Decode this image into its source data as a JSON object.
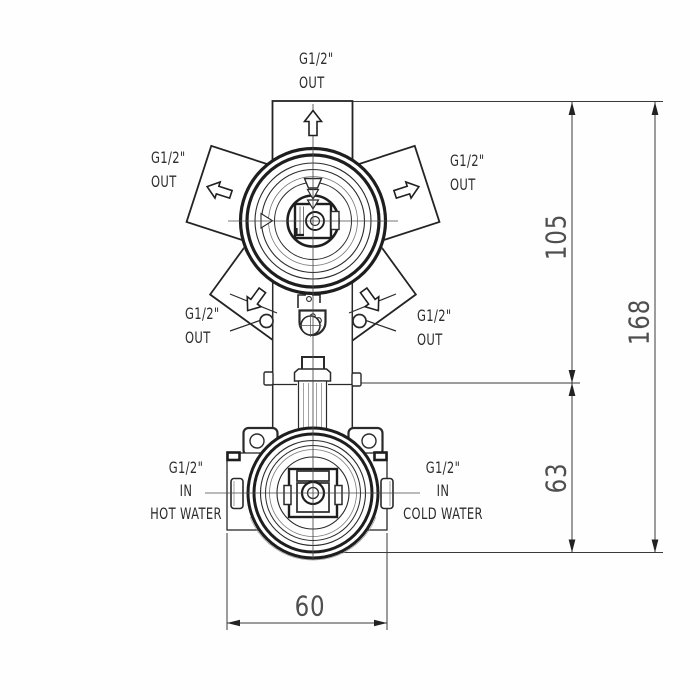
{
  "labels": {
    "outlet_top": {
      "size": "G1/2\"",
      "flow": "OUT"
    },
    "outlet_upper_left": {
      "size": "G1/2\"",
      "flow": "OUT"
    },
    "outlet_upper_right": {
      "size": "G1/2\"",
      "flow": "OUT"
    },
    "outlet_lower_left": {
      "size": "G1/2\"",
      "flow": "OUT"
    },
    "outlet_lower_right": {
      "size": "G1/2\"",
      "flow": "OUT"
    },
    "inlet_hot": {
      "size": "G1/2\"",
      "flow": "IN",
      "medium": "HOT WATER"
    },
    "inlet_cold": {
      "size": "G1/2\"",
      "flow": "IN",
      "medium": "COLD WATER"
    }
  },
  "dimensions": {
    "upper_section": "105",
    "lower_section": "63",
    "overall_height": "168",
    "body_width": "60"
  },
  "colors": {
    "line": "#2a2a2a",
    "dim_line": "#3a3a3a",
    "text": "#2d2d2d",
    "dim_text": "#4f4f4f",
    "background": "#fefefe"
  }
}
